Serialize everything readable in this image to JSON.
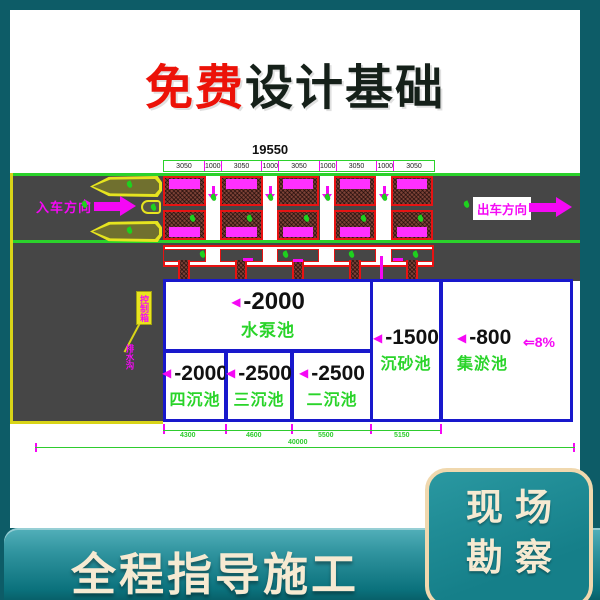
{
  "page": {
    "title_highlight": "免费",
    "title_rest": "设计基础",
    "bottom_banner": "全程指导施工",
    "corner_badge_line1": "现场",
    "corner_badge_line2": "勘察"
  },
  "drawing": {
    "dim_total_top": "19550",
    "dim_segments": [
      "3050",
      "1000",
      "3050",
      "1000",
      "3050",
      "1000",
      "3050",
      "1000",
      "3050"
    ],
    "entry_label": "入车方向",
    "exit_label": "出车方向",
    "control_box_label": "控制箱",
    "drain_note": "排水沟",
    "slope_label": "⇐8%",
    "marker_triangle": "◀",
    "pools": {
      "pump": {
        "depth": "-2000",
        "name": "水泵池"
      },
      "four": {
        "depth": "-2000",
        "name": "四沉池"
      },
      "three": {
        "depth": "-2500",
        "name": "三沉池"
      },
      "two": {
        "depth": "-2500",
        "name": "二沉池"
      },
      "sand": {
        "depth": "-1500",
        "name": "沉砂池"
      },
      "sludge": {
        "depth": "-800",
        "name": "集淤池"
      }
    },
    "dims_bottom": [
      "4300",
      "4600",
      "5500",
      "5150"
    ],
    "dim_total_bottom": "40000",
    "plant_markers": [
      [
        127,
        181
      ],
      [
        127,
        227
      ],
      [
        82,
        201
      ],
      [
        151,
        204
      ],
      [
        211,
        194
      ],
      [
        268,
        194
      ],
      [
        325,
        194
      ],
      [
        382,
        194
      ],
      [
        190,
        215
      ],
      [
        247,
        215
      ],
      [
        304,
        215
      ],
      [
        361,
        215
      ],
      [
        418,
        215
      ],
      [
        200,
        251
      ],
      [
        283,
        251
      ],
      [
        349,
        251
      ],
      [
        413,
        251
      ],
      [
        196,
        309
      ],
      [
        464,
        201
      ],
      [
        282,
        333
      ]
    ]
  },
  "colors": {
    "background_teal": "#0d5c67",
    "banner_teal_light": "#4aa8b2",
    "banner_teal_dark": "#0b727d",
    "badge_border_cream": "#f0d8ae",
    "badge_text_cream": "#f6ead2",
    "title_red": "#ec1208",
    "title_dark": "#152019",
    "cad_green": "#2ad42a",
    "cad_magenta": "#f508f5",
    "cad_red": "#e81212",
    "cad_blue": "#1818cc",
    "cad_yellow": "#e6e41f",
    "road_gray": "#464646",
    "brick_brown": "#7c4237"
  }
}
